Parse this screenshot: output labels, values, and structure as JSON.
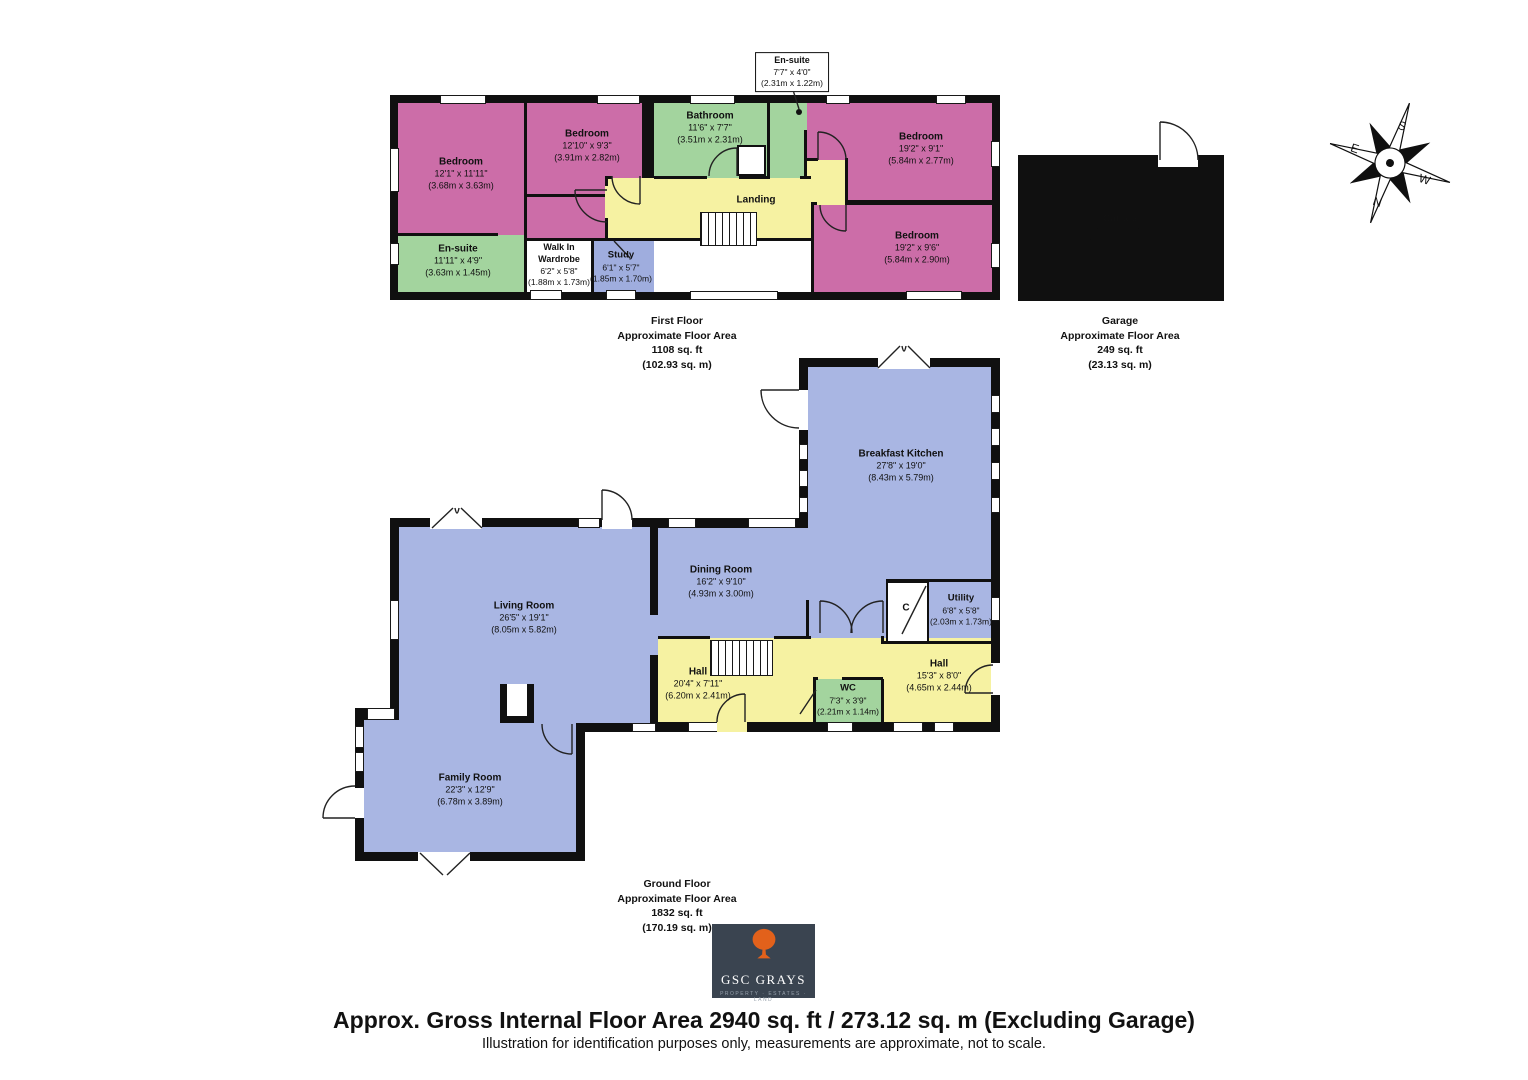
{
  "colors": {
    "pink": "#cc6da8",
    "green": "#a3d49e",
    "yellow": "#f6f2a2",
    "blue": "#a9b6e3",
    "study": "#9fadde",
    "logo_bg": "#3a4450",
    "logo_accent": "#e2611b"
  },
  "compass": {
    "n": "N",
    "e": "E",
    "s": "S",
    "w": "W"
  },
  "first_floor": {
    "callout": {
      "name": "En-suite",
      "dims_ft": "7'7\" x 4'0\"",
      "dims_m": "(2.31m x 1.22m)"
    },
    "rooms": {
      "bedroom_left": {
        "name": "Bedroom",
        "dims_ft": "12'1\" x 11'11\"",
        "dims_m": "(3.68m x 3.63m)"
      },
      "bedroom_mid": {
        "name": "Bedroom",
        "dims_ft": "12'10\" x 9'3\"",
        "dims_m": "(3.91m x 2.82m)"
      },
      "bathroom": {
        "name": "Bathroom",
        "dims_ft": "11'6\" x 7'7\"",
        "dims_m": "(3.51m x 2.31m)"
      },
      "bedroom_right_top": {
        "name": "Bedroom",
        "dims_ft": "19'2\" x 9'1\"",
        "dims_m": "(5.84m x 2.77m)"
      },
      "bedroom_right_bottom": {
        "name": "Bedroom",
        "dims_ft": "19'2\" x 9'6\"",
        "dims_m": "(5.84m x 2.90m)"
      },
      "landing": {
        "name": "Landing"
      },
      "ensuite_lower": {
        "name": "En-suite",
        "dims_ft": "11'11\" x 4'9\"",
        "dims_m": "(3.63m x 1.45m)"
      },
      "wardrobe": {
        "name_line1": "Walk In",
        "name_line2": "Wardrobe",
        "dims_ft": "6'2\" x 5'8\"",
        "dims_m": "(1.88m x 1.73m)"
      },
      "study": {
        "name": "Study",
        "dims_ft": "6'1\" x 5'7\"",
        "dims_m": "(1.85m x 1.70m)"
      }
    },
    "area": {
      "line1": "First Floor",
      "line2": "Approximate Floor Area",
      "line3": "1108 sq. ft",
      "line4": "(102.93 sq. m)"
    }
  },
  "garage": {
    "room": {
      "name": "Garage",
      "dims_ft": "19'1\" x 13'1\"",
      "dims_m": "(5.82m x 3.99m)"
    },
    "area": {
      "line1": "Garage",
      "line2": "Approximate Floor Area",
      "line3": "249 sq. ft",
      "line4": "(23.13 sq. m)"
    }
  },
  "ground_floor": {
    "rooms": {
      "breakfast_kitchen": {
        "name": "Breakfast Kitchen",
        "dims_ft": "27'8\" x 19'0\"",
        "dims_m": "(8.43m x 5.79m)"
      },
      "dining_room": {
        "name": "Dining Room",
        "dims_ft": "16'2\" x 9'10\"",
        "dims_m": "(4.93m x 3.00m)"
      },
      "utility": {
        "name": "Utility",
        "dims_ft": "6'8\" x 5'8\"",
        "dims_m": "(2.03m x 1.73m)"
      },
      "cupboard": {
        "name": "C"
      },
      "hall_left": {
        "name": "Hall",
        "dims_ft": "20'4\" x 7'11\"",
        "dims_m": "(6.20m x 2.41m)"
      },
      "wc": {
        "name": "WC",
        "dims_ft": "7'3\" x 3'9\"",
        "dims_m": "(2.21m x 1.14m)"
      },
      "hall_right": {
        "name": "Hall",
        "dims_ft": "15'3\" x 8'0\"",
        "dims_m": "(4.65m x 2.44m)"
      },
      "living_room": {
        "name": "Living Room",
        "dims_ft": "26'5\" x 19'1\"",
        "dims_m": "(8.05m x 5.82m)"
      },
      "family_room": {
        "name": "Family Room",
        "dims_ft": "22'3\" x 12'9\"",
        "dims_m": "(6.78m x 3.89m)"
      }
    },
    "area": {
      "line1": "Ground Floor",
      "line2": "Approximate Floor Area",
      "line3": "1832 sq. ft",
      "line4": "(170.19 sq. m)"
    }
  },
  "logo": {
    "name": "GSC GRAYS",
    "tagline": "PROPERTY · ESTATES · LAND"
  },
  "footer": {
    "title": "Approx. Gross Internal Floor Area 2940 sq. ft / 273.12 sq. m (Excluding Garage)",
    "subtitle": "Illustration for identification purposes only, measurements are approximate, not to scale."
  }
}
